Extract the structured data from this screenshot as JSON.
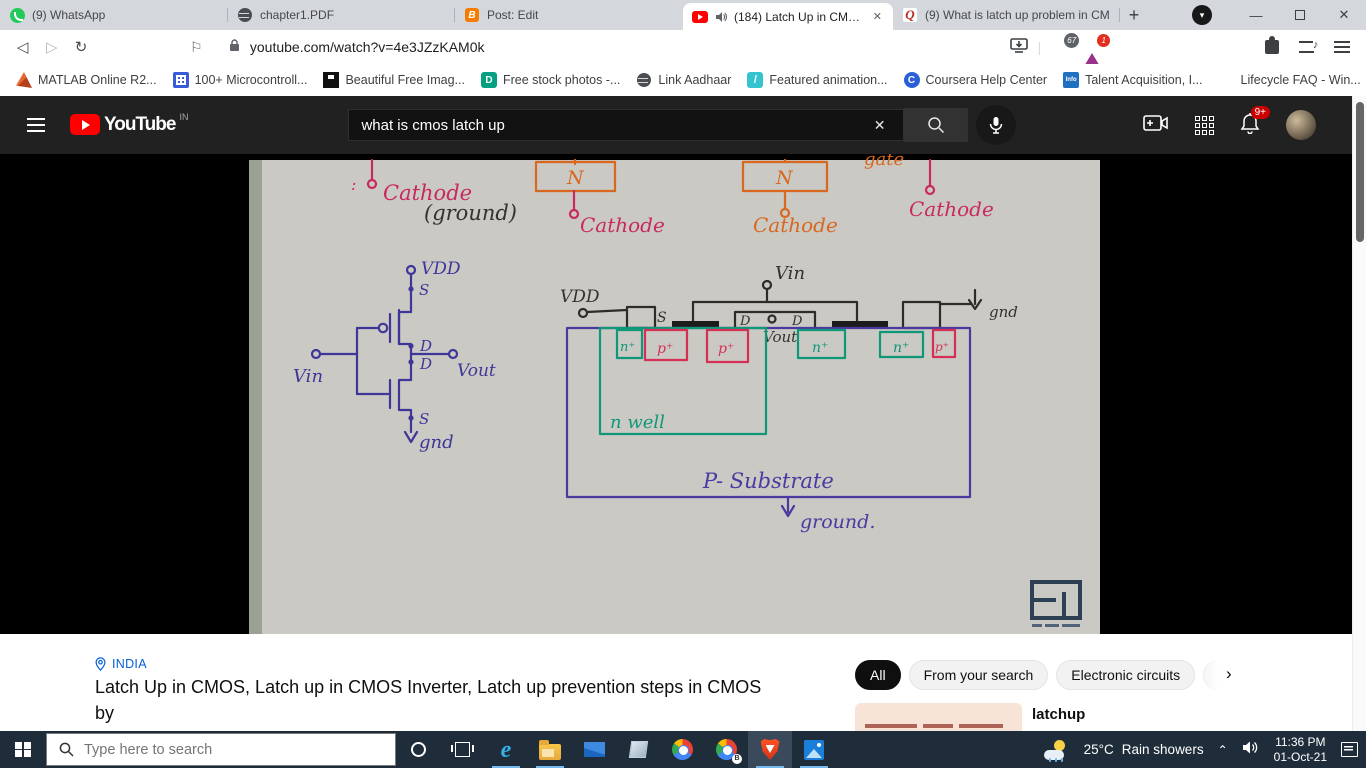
{
  "colors": {
    "youtube_red": "#ff0000",
    "accent_blue": "#065fd4",
    "badge_red": "#cc0000",
    "brave_orange": "#fb542b",
    "taskbar_bg": "#1f2d3b",
    "masthead_bg": "#212121",
    "ink_pink": "#c9295f",
    "ink_orange": "#d8681f",
    "ink_blue": "#3f3699",
    "ink_green": "#0f9878",
    "ink_red": "#d62f56",
    "ink_black": "#34322e",
    "ink_purple": "#4a3aa0",
    "whiteboard_bg": "#cac9c4"
  },
  "browser": {
    "tabs": [
      {
        "title": "(9) WhatsApp"
      },
      {
        "title": "chapter1.PDF"
      },
      {
        "title": "Post: Edit"
      },
      {
        "title": "(184) Latch Up in CMOS, La"
      },
      {
        "title": "(9) What is latch up problem in CM"
      }
    ],
    "address": {
      "url": "youtube.com/watch?v=4e3JZzKAM0k"
    },
    "shield_badge": "67",
    "rewards_badge": "1",
    "bookmarks": [
      {
        "label": "MATLAB Online R2..."
      },
      {
        "label": "100+ Microcontroll..."
      },
      {
        "label": "Beautiful Free Imag..."
      },
      {
        "label": "Free stock photos -..."
      },
      {
        "label": "Link Aadhaar"
      },
      {
        "label": "Featured animation..."
      },
      {
        "label": "Coursera Help Center"
      },
      {
        "label": "Talent Acquisition, I..."
      },
      {
        "label": "Lifecycle FAQ - Win..."
      }
    ]
  },
  "icons": {
    "blogger": "B",
    "quora": "Q",
    "pexels": "D",
    "slash": "/",
    "coursera": "C",
    "infosys": "Info",
    "back": "◁",
    "forward": "▷",
    "reload": "↻",
    "bookmark_flag": "⚐",
    "overflow": "»",
    "new_tab": "+",
    "caret_down": "▾",
    "minimize": "—",
    "close": "✕",
    "clear_x": "✕",
    "chip_next": "›",
    "tray_up": "⌃",
    "ie": "e",
    "colon": ":"
  },
  "youtube": {
    "logo": "YouTube",
    "region": "IN",
    "search_value": "what is cmos latch up",
    "notif_badge": "9+"
  },
  "whiteboard": {
    "cathode": "Cathode",
    "ground_paren": "(ground)",
    "n_label": "N",
    "gate": "gate",
    "vdd": "VDD",
    "s": "S",
    "d": "D",
    "vin": "Vin",
    "vout": "Vout",
    "gnd": "gnd",
    "n_plus": "n⁺",
    "p_plus": "p⁺",
    "n_well": "n well",
    "substrate": "P- Substrate",
    "ground_word": "ground."
  },
  "below_video": {
    "location": "INDIA",
    "title_line1": "Latch Up in CMOS, Latch up in CMOS Inverter, Latch up prevention steps in CMOS by",
    "title_line2": "Engineering Funda",
    "chips": [
      {
        "label": "All"
      },
      {
        "label": "From your search"
      },
      {
        "label": "Electronic circuits"
      }
    ],
    "related_title": "latchup"
  },
  "taskbar": {
    "search_placeholder": "Type here to search",
    "temperature": "25°C",
    "condition": "Rain showers",
    "time": "11:36 PM",
    "date": "01-Oct-21"
  }
}
